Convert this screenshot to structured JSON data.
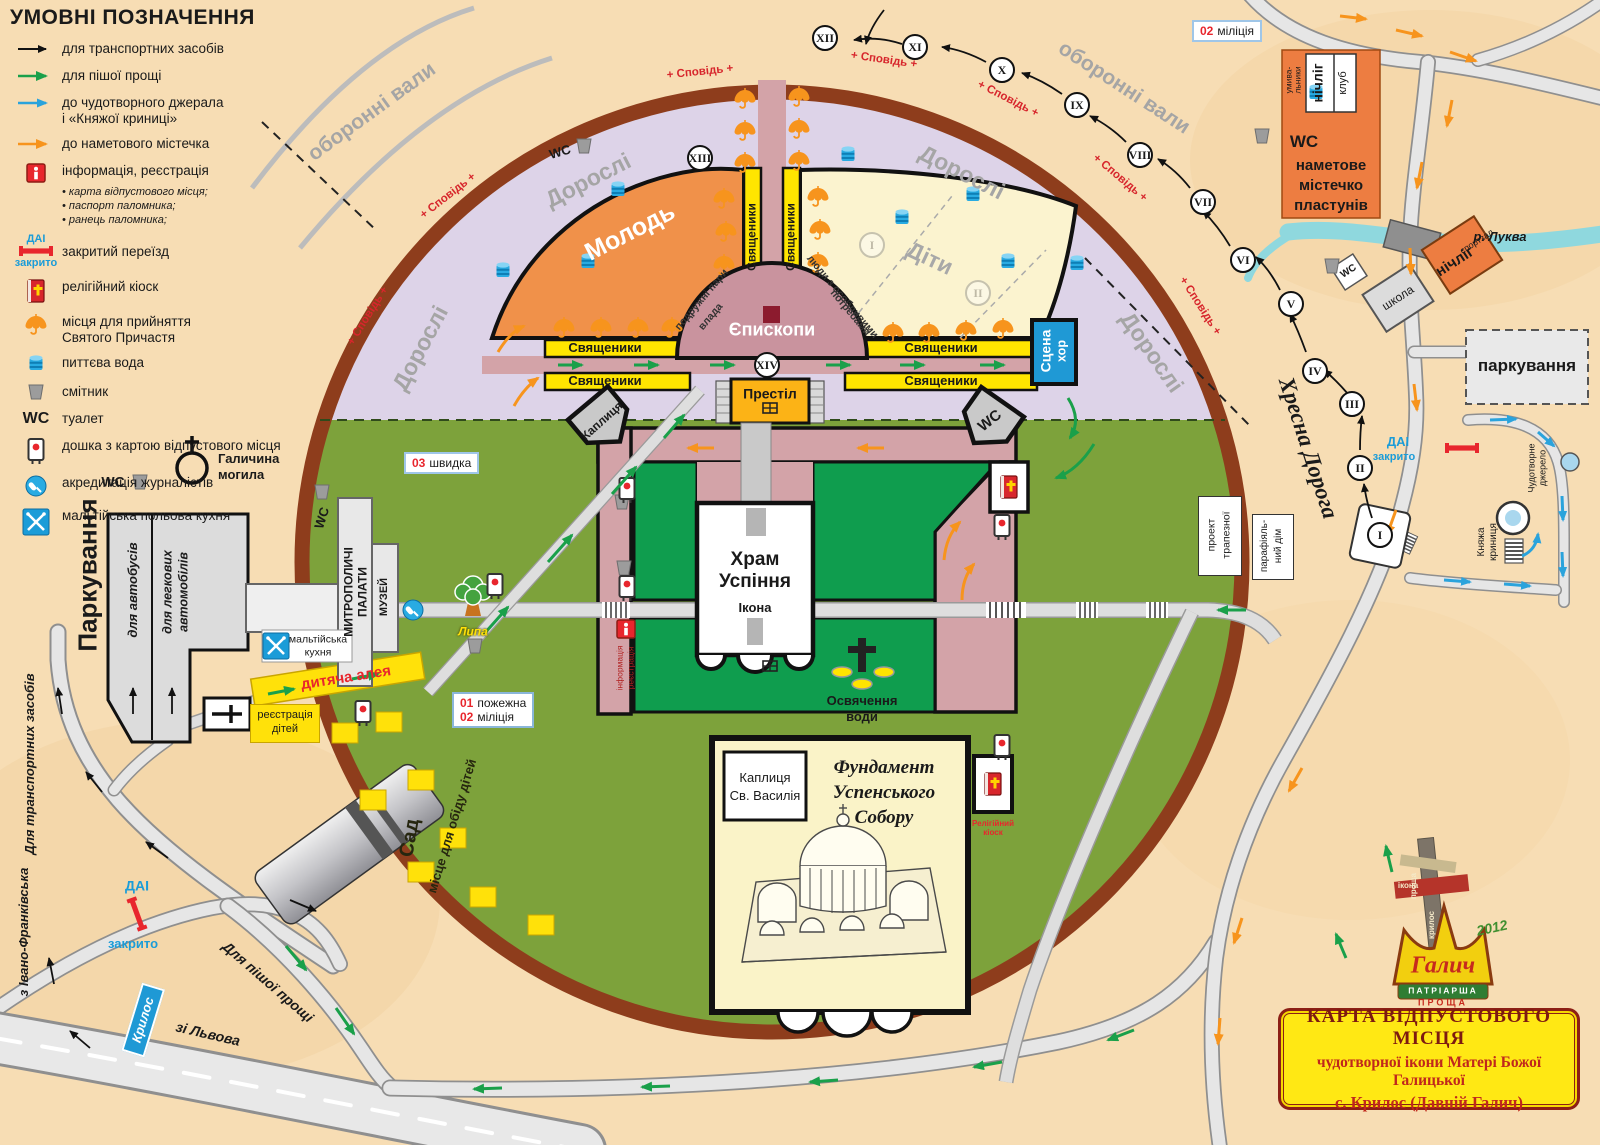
{
  "legend": {
    "title": "УМОВНІ ПОЗНАЧЕННЯ",
    "items": [
      {
        "icon": "black-arrow",
        "label": "для транспортних засобів"
      },
      {
        "icon": "green-arrow",
        "label": "для пішої прощі"
      },
      {
        "icon": "blue-arrow",
        "label": "до чудотворного джерала",
        "label2": "і «Княжої криниці»"
      },
      {
        "icon": "orange-arrow",
        "label": "до наметового містечка"
      },
      {
        "icon": "info-icon",
        "label": "інформація, реєстрація"
      },
      {
        "icon": "dai-closed-icon",
        "label": "закритий переїзд"
      },
      {
        "icon": "religious-kiosk-icon",
        "label": "релігійний кіоск"
      },
      {
        "icon": "communion-umbrella-icon",
        "label": "місця для прийняття",
        "label2": "Святого Причастя"
      },
      {
        "icon": "drinking-water-icon",
        "label": "питтєва вода"
      },
      {
        "icon": "trash-icon",
        "label": "смітник"
      },
      {
        "icon": "wc",
        "label": "туалет"
      },
      {
        "icon": "map-board-icon",
        "label": "дошка з картою відпустового місця"
      },
      {
        "icon": "press-icon",
        "label": "акредитація журналістів"
      },
      {
        "icon": "maltese-kitchen-icon",
        "label": "мальтійська польова кухня"
      }
    ],
    "info_subs": [
      "• карта відпустового місця;",
      "• паспорт паломника;",
      "• ранець паломника;"
    ]
  },
  "zones": {
    "dorosli": "Дорослі",
    "molod": "Молодь",
    "dity": "Діти",
    "yepyskopy": "Єпископи",
    "svyashchenyky": "Священики",
    "stage1": "Сцена",
    "stage2": "хор",
    "podruzhni": "подружні пари",
    "vlada": "влада",
    "lyudy1": "люди з особливими",
    "lyudy2": "потребами",
    "sad": "Сад",
    "misce": "місце для обіду дітей"
  },
  "center": {
    "prestil": "Престіл",
    "khram1": "Храм",
    "khram2": "Успіння",
    "ikona": "Ікона",
    "kaplytsya": "Каплиця",
    "osv1": "Освячення",
    "osv2": "води",
    "fund1": "Фундамент",
    "fund2": "Успенського",
    "fund3": "Собору",
    "kapvas1": "Каплиця",
    "kapvas2": "Св. Василія",
    "info_v1": "інформація",
    "info_v2": "реєстрація",
    "kiosk1": "Релігійний",
    "kiosk2": "кіоск"
  },
  "services": {
    "shvydka_num": "03",
    "shvydka": "швидка",
    "pozhezhna_num": "01",
    "pozhezhna": "пожежна",
    "militsiya_num": "02",
    "militsiya": "міліція",
    "reyd1": "реєстрація",
    "reyd2": "дітей",
    "aleya": "дитяча алея",
    "malt1": "мальтійська",
    "malt2": "кухня"
  },
  "left": {
    "parkuvannya": "Паркування",
    "avtobusiv": "для автобусів",
    "legk1": "для легкових",
    "legk2": "автомобілів",
    "halych1": "Галичина",
    "halych2": "могила",
    "mytro1": "МИТРОПОЛИЧІ",
    "mytro2": "ПАЛАТИ",
    "muzey": "МУЗЕЙ",
    "lypa": "Липа"
  },
  "roads": {
    "transport_v": "Для транспортних засобів",
    "pisha": "Для пішої прощі",
    "ivano": "з Івано-Франківська",
    "lviv": "зі Львова",
    "krylos": "Крилос",
    "dai": "ДАІ",
    "zakryto": "закрито",
    "khresna": "Хресна Дорога"
  },
  "right": {
    "luka": "р. Луква",
    "shkola": "школа",
    "nichlig": "нічліг",
    "sportzal": "спортзал",
    "parkuvannya": "паркування",
    "kn1": "Княжа",
    "kn2": "криниця",
    "dzh1": "Чудотворне",
    "dzh2": "джерело",
    "pr1": "проект",
    "pr2": "трапезної",
    "pa1": "парафіяль-",
    "pa2": "ний дім"
  },
  "camp": {
    "l1": "наметове",
    "l2": "містечко",
    "l3": "пластунів",
    "nichlig": "нічліг",
    "klub": "клуб",
    "um1": "умива-",
    "um2": "льники"
  },
  "ring": {
    "spovid_full": "+ Сповідь +",
    "oboronni": "оборонні вали"
  },
  "stations": {
    "route": [
      "I",
      "II",
      "III",
      "IV",
      "V",
      "VI",
      "VII",
      "VIII",
      "IX",
      "X",
      "XI",
      "XII",
      "XIII",
      "XIV"
    ],
    "faded": [
      "I",
      "II"
    ]
  },
  "misc": {
    "wc": "WC"
  },
  "title_box": {
    "line1": "КАРТА ВІДПУСТОВОГО МІСЦЯ",
    "line2": "чудотворної ікони Матері Божої Галицької",
    "line3": "с. Крилос (Давній Галич)"
  },
  "logo": {
    "halych": "Галич",
    "patriarsha": "ПАТРІАРША",
    "proshcha": "ПРОЩА",
    "year": "2012",
    "cross_word1": "проща",
    "cross_word2": "ікона",
    "cross_word3": "крилос"
  },
  "colors": {
    "paper": "#f7ddb4",
    "ring_brown": "#8e3d1c",
    "purple": "#ddd3e8",
    "olive": "#7da23b",
    "dark_green": "#0f9d4e",
    "pink": "#d3a3a8",
    "orange_zone": "#f0914a",
    "cream": "#fbf3cf",
    "yellow": "#ffe500",
    "blue": "#1f99d5",
    "accent_red": "#d7262c",
    "orange_arrow": "#f7941d"
  }
}
